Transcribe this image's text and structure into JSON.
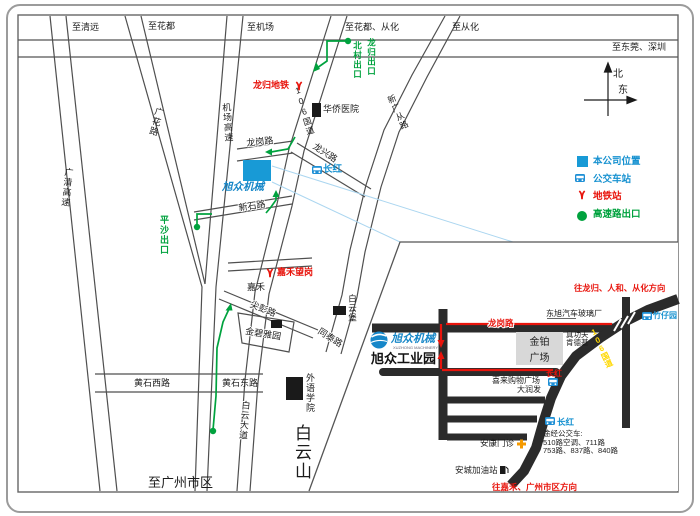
{
  "colors": {
    "company_blue": "#189ad6",
    "accent_blue": "#1691d0",
    "red": "#e8140c",
    "green": "#00a23e",
    "yellow": "#ffd800",
    "road_gray": "#4f4f4f",
    "inset_road_black": "#2b2b2b",
    "plaza_gray": "#d8d8d8",
    "wedge_blue": "#abd6f0"
  },
  "top": {
    "qingyuan": "至清远",
    "huadu": "至花都",
    "jichang": "至机场",
    "huadu_conghua": "至花都、从化",
    "conghua": "至从化",
    "dongguan_shenzhen": "至东莞、深圳"
  },
  "compass": {
    "north": "北",
    "east": "东"
  },
  "legend": {
    "company": "本公司位置",
    "bus": "公交车站",
    "metro": "地铁站",
    "exit": "高速路出口"
  },
  "roads": {
    "guangqing": "广清高速",
    "guanghua": "广花路",
    "jichang_gs": "机场高速",
    "g106": "106国道",
    "xinguangcong": "新广从路",
    "longgang": "龙岗路",
    "xinshi": "新石路",
    "longxing": "龙兴路",
    "jianpeng": "尖彭路",
    "tongtai": "同泰路",
    "huangshi_w": "黄石西路",
    "huangshi_e": "黄石东路",
    "baiyun_av": "白云大道",
    "jiahe": "嘉禾"
  },
  "places": {
    "longgui_metro": "龙归地铁",
    "huaqiao_hospital": "华侨医院",
    "changhong": "长红",
    "xuzhong": "旭众机械",
    "jiahewanggang": "嘉禾望岗",
    "jinbiyayuan": "金碧雅园",
    "baiyunbu": "白云堡",
    "waiyu": "外语学院",
    "baiyunshan": "白云山",
    "to_guangzhou": "至广州市区",
    "pingsha_exit": "平沙出口",
    "beicun_exit": "北村出口",
    "longgui_exit": "龙归出口"
  },
  "inset": {
    "dir_north": "往龙归、人和、从化方向",
    "zhuzaiyuan": "竹仔园",
    "dongxu_glass": "东旭汽车玻璃厂",
    "longgang": "龙岗路",
    "jinbo1": "金铂",
    "jinbo2": "广场",
    "zhengongfu": "真功夫",
    "kfc": "肯德基",
    "xilai": "喜来购物广场",
    "darunfa": "大润发",
    "changhong": "长红",
    "g106": "106国道",
    "bus_title": "途经公交车:",
    "bus_line1": "510路空调、711路",
    "bus_line2": "753路、837路、840路",
    "ankang": "安康门诊",
    "ancheng": "安城加油站",
    "dir_south": "往嘉禾、广州市区方向",
    "logo_name": "旭众机械",
    "logo_sub": "XUZHONG MACHINERY",
    "logo_park": "旭众工业园"
  }
}
